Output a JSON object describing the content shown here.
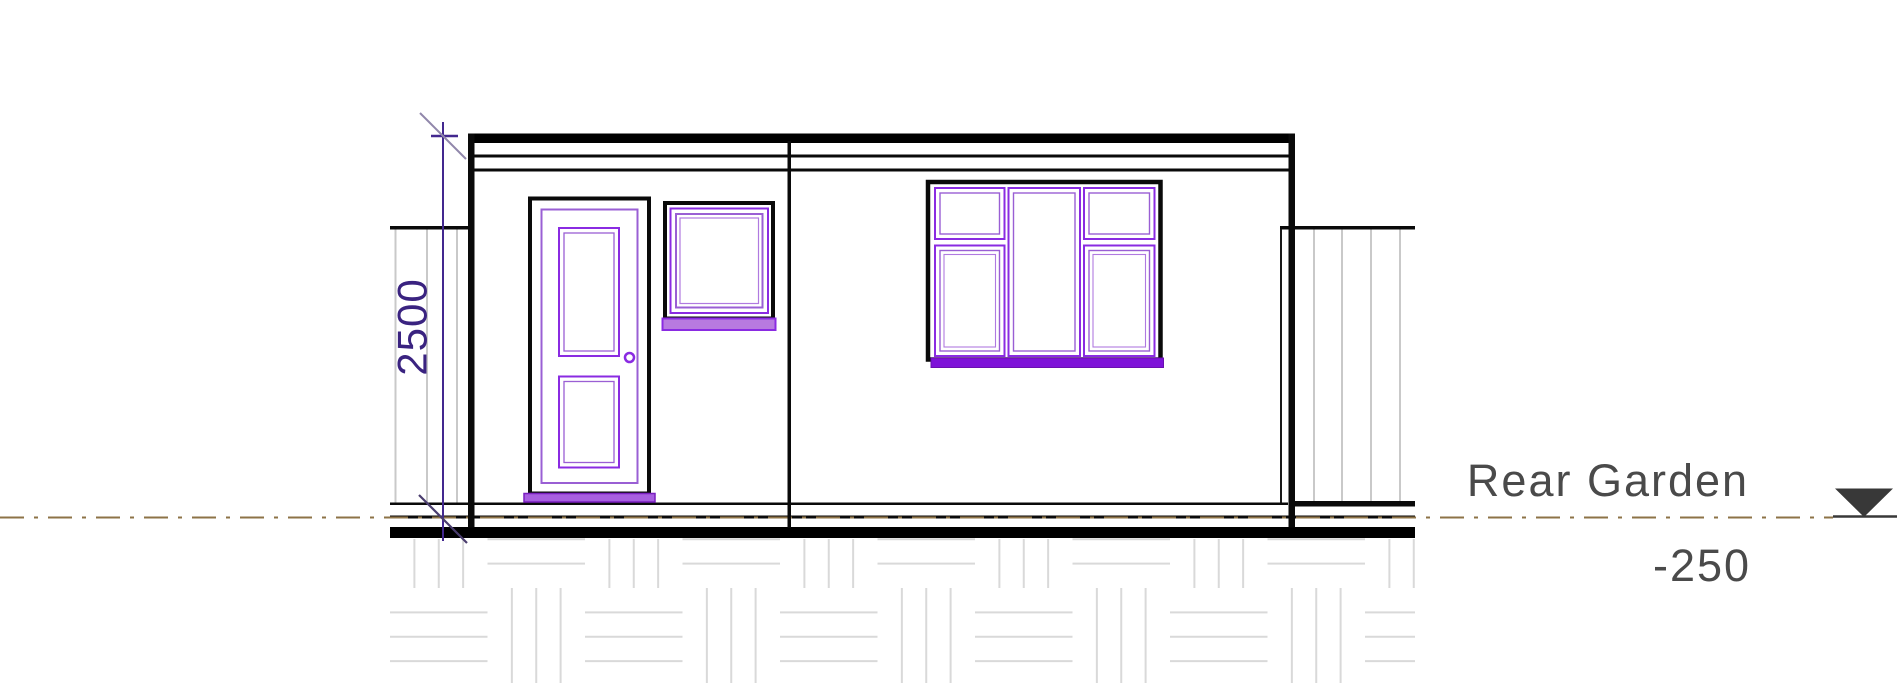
{
  "drawing": {
    "title": "Rear Garden Elevation",
    "dimension": {
      "value": "2500"
    },
    "level": {
      "name": "Rear Garden",
      "elevation": "-250"
    },
    "colors": {
      "line_black": "#0a0a0a",
      "window_door_purple": "#8a2be2",
      "window_sill_purple": "#7e12d8",
      "small_sill_light_purple": "#b87ae0",
      "door_threshold_purple": "#a85fe0",
      "dimension_purple": "#43288f",
      "dimension_text_purple": "#3a2380",
      "tick_slash_gray": "#9187ab",
      "level_line_brown": "#8d7347",
      "annotation_text_gray": "#4a4a4a",
      "level_marker_dark": "#383838",
      "fence_gray": "#c9c9c9",
      "foundation_gray": "#d9d9d9"
    }
  }
}
